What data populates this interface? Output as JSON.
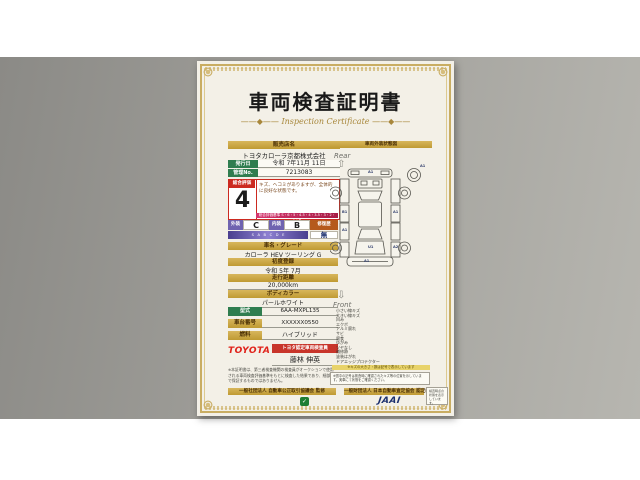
{
  "colors": {
    "paper": "#f3f0e7",
    "gold": "#c8a23a",
    "green": "#2f7d4f",
    "red": "#cc2a20",
    "purple": "#6f63b0",
    "magenta": "#c43a6e",
    "orange": "#b55a1c",
    "navy": "#1b2f6e",
    "toyota_red": "#e0231b",
    "background_gray": "#a3a29d"
  },
  "certificate": {
    "title": "車両検査証明書",
    "subtitle": "Inspection Certificate",
    "subtitle_flourish": "——◆——",
    "dealer": {
      "label": "販売店名",
      "name": "トヨタカローラ京都株式会社"
    },
    "issue": {
      "label": "発行日",
      "value": "令和 7年11月 11日"
    },
    "manage": {
      "label": "管理No.",
      "value": "7213083"
    },
    "overall": {
      "label": "総合評価",
      "score": "4",
      "comment": "キズ、ヘコミがありますが、全体的に良好な状態です。",
      "scale_note": "総合評価基準 S・6・5・4.5・4・3.5・3・2・1・R"
    },
    "ratings": {
      "exterior_label": "外装",
      "exterior": "C",
      "interior_label": "内装",
      "interior": "B",
      "repair_label": "修復歴",
      "repair": "無",
      "scale_bar": "S　A　B　C　D　E"
    },
    "fields": [
      {
        "label": "車名・グレード",
        "value": "カローラ HEV ツーリング G"
      },
      {
        "label": "初度登録",
        "value": "令和 5年 7月"
      },
      {
        "label": "走行距離",
        "value": "20,000km"
      },
      {
        "label": "ボディカラー",
        "value": "パールホワイト"
      }
    ],
    "specs": [
      {
        "label": "型式",
        "value": "6AA-MXPL135"
      },
      {
        "label": "車台番号",
        "value": "XXXXXX0550"
      },
      {
        "label": "燃料",
        "value": "ハイブリッド"
      }
    ],
    "inspector": {
      "brand": "TOYOTA",
      "badge": "トヨタ認定車両検査員",
      "name": "藤林 伸英"
    },
    "fine_print": "※本証明書は、第三者検査機関の検査員がオークションで使用される車両検査評価基準をもとに検査した結果であり、細部まで保証するものではありません。",
    "diagram": {
      "header": "車両外装状態図",
      "rear_label": "Rear",
      "front_label": "Front",
      "marks": [
        "A1",
        "A1",
        "B1",
        "A1",
        "A1",
        "U1",
        "A1",
        "A2"
      ],
      "legend": [
        "小さい線キズ",
        "大きい線キズ",
        "凹み",
        "エクボ",
        "アルミ腐れ",
        "サビ",
        "腐食",
        "ゆがみ",
        "ツヤなし",
        "補修跡",
        "塗装はがれ",
        "ドアエッジプロテクター"
      ],
      "legend_note": "※キズの大きさ・数は記号で表示しています",
      "diagram_note": "※図中の記号は検査時に確認されたキズ等の位置を示しています。実車にて状態をご確認ください。"
    },
    "footer": {
      "left_bar": "一般社団法人 自動車公正取引協議会 監修",
      "right_bar": "一般財団法人 日本自動車査定協会 認定検査",
      "jaai_logo": "JAAI",
      "mark_glyph": "✓",
      "side_note": "検査時点の状態を表示しています。"
    }
  }
}
